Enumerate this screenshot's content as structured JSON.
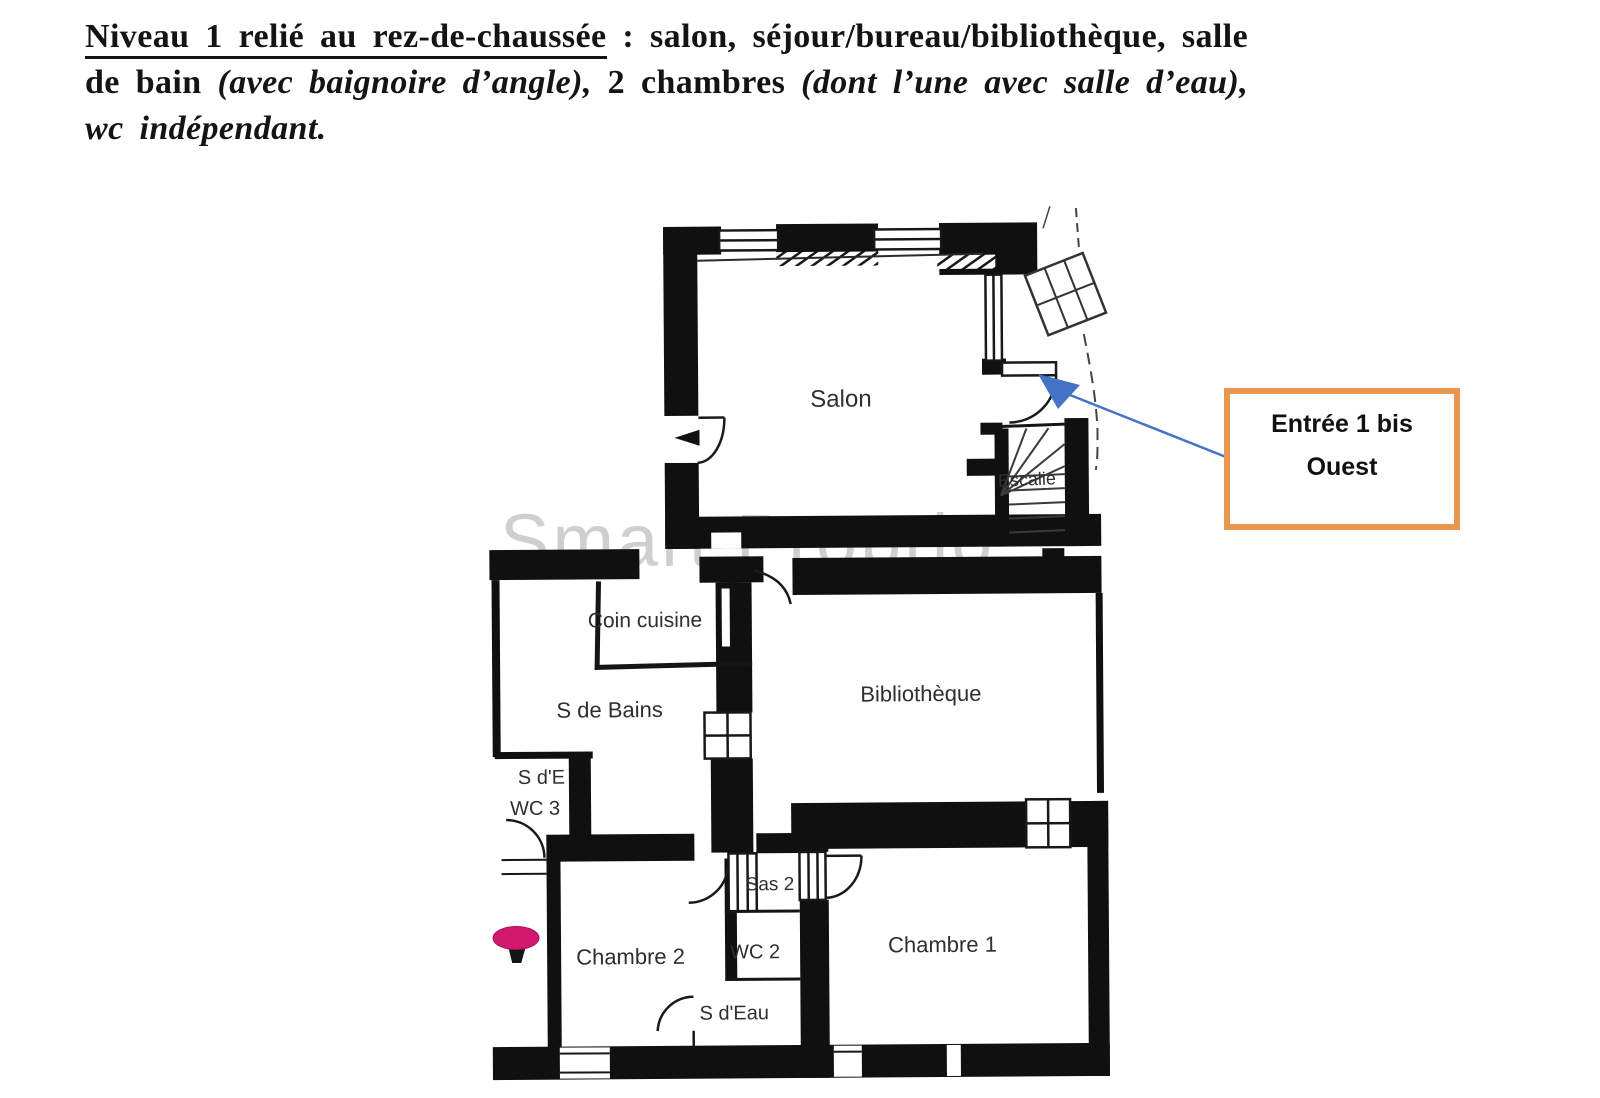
{
  "header": {
    "line1_underlined": "Niveau 1 relié au rez-de-chaussée",
    "line1_rest": " : salon, séjour/bureau/bibliothèque, salle",
    "line2_normal1": "de bain ",
    "line2_italic1": "(avec baignoire d’angle),",
    "line2_normal2": " 2 chambres ",
    "line2_italic2": "(dont l’une avec salle d’eau),",
    "line3_italic": "wc indépendant."
  },
  "plan": {
    "watermark": "Smart Proprio",
    "rooms": {
      "salon": "Salon",
      "escalier": "Escalie",
      "coin_cuisine": "Coin cuisine",
      "salle_de_bains": "S de Bains",
      "sde_line1": "S d'E",
      "sde_line2": "WC 3",
      "bibliotheque": "Bibliothèque",
      "sas": "Sas 2",
      "wc2": "WC 2",
      "s_deau": "S d'Eau",
      "chambre2": "Chambre 2",
      "chambre1": "Chambre 1"
    },
    "colors": {
      "wall": "#101010",
      "arrow_blue": "#4472C4",
      "pin_pink": "#D2186F",
      "callout_orange": "#E8964F",
      "watermark_grey": "#A0A0A0"
    }
  },
  "callout": {
    "line1": "Entrée 1 bis",
    "line2": "Ouest"
  }
}
